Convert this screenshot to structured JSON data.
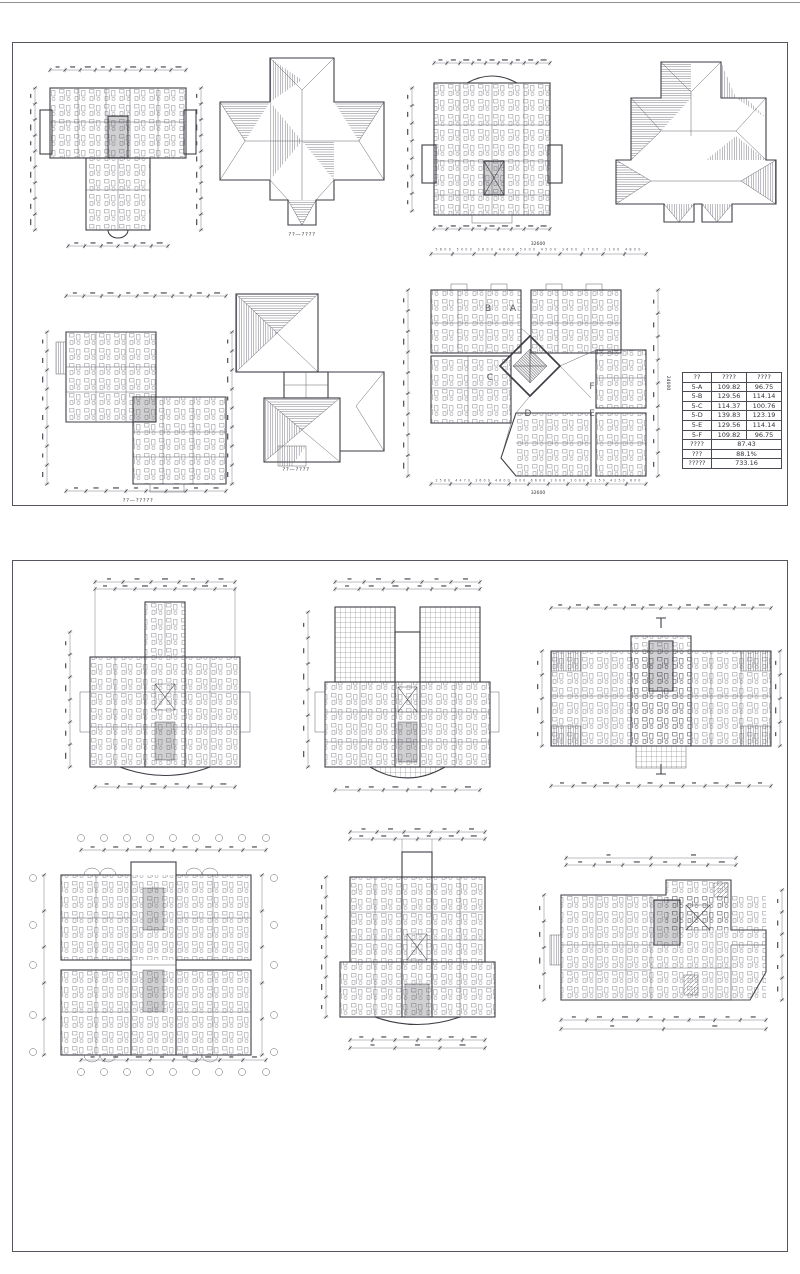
{
  "captions": {
    "roof_plan_1": "??—????",
    "floor_plan_step": "??—?????",
    "roof_plan_2": "??—????"
  },
  "tower_plan": {
    "units": [
      "A",
      "B",
      "C",
      "D",
      "E",
      "F"
    ],
    "dim_top_total": "32600",
    "dim_top_segments": "5600 5000 3600 4600 5000 4500 3600 1700 2100 4800",
    "dim_bottom_segments": "2580 4470 3600 4600 600 6600 2000 2000 2150 4250 600",
    "dim_bottom_total": "32600",
    "dim_right_total": "24600"
  },
  "area_table": {
    "headers": [
      "??",
      "????",
      "????"
    ],
    "rows": [
      [
        "5-A",
        "109.82",
        "96.75"
      ],
      [
        "5-B",
        "129.56",
        "114.14"
      ],
      [
        "5-C",
        "114.37",
        "100.76"
      ],
      [
        "5-D",
        "139.83",
        "123.19"
      ],
      [
        "5-E",
        "129.56",
        "114.14"
      ],
      [
        "5-F",
        "109.82",
        "96.75"
      ]
    ],
    "summary": [
      [
        "????",
        "87.43"
      ],
      [
        "???",
        "88.1%"
      ],
      [
        "?????",
        "733.16"
      ]
    ]
  }
}
